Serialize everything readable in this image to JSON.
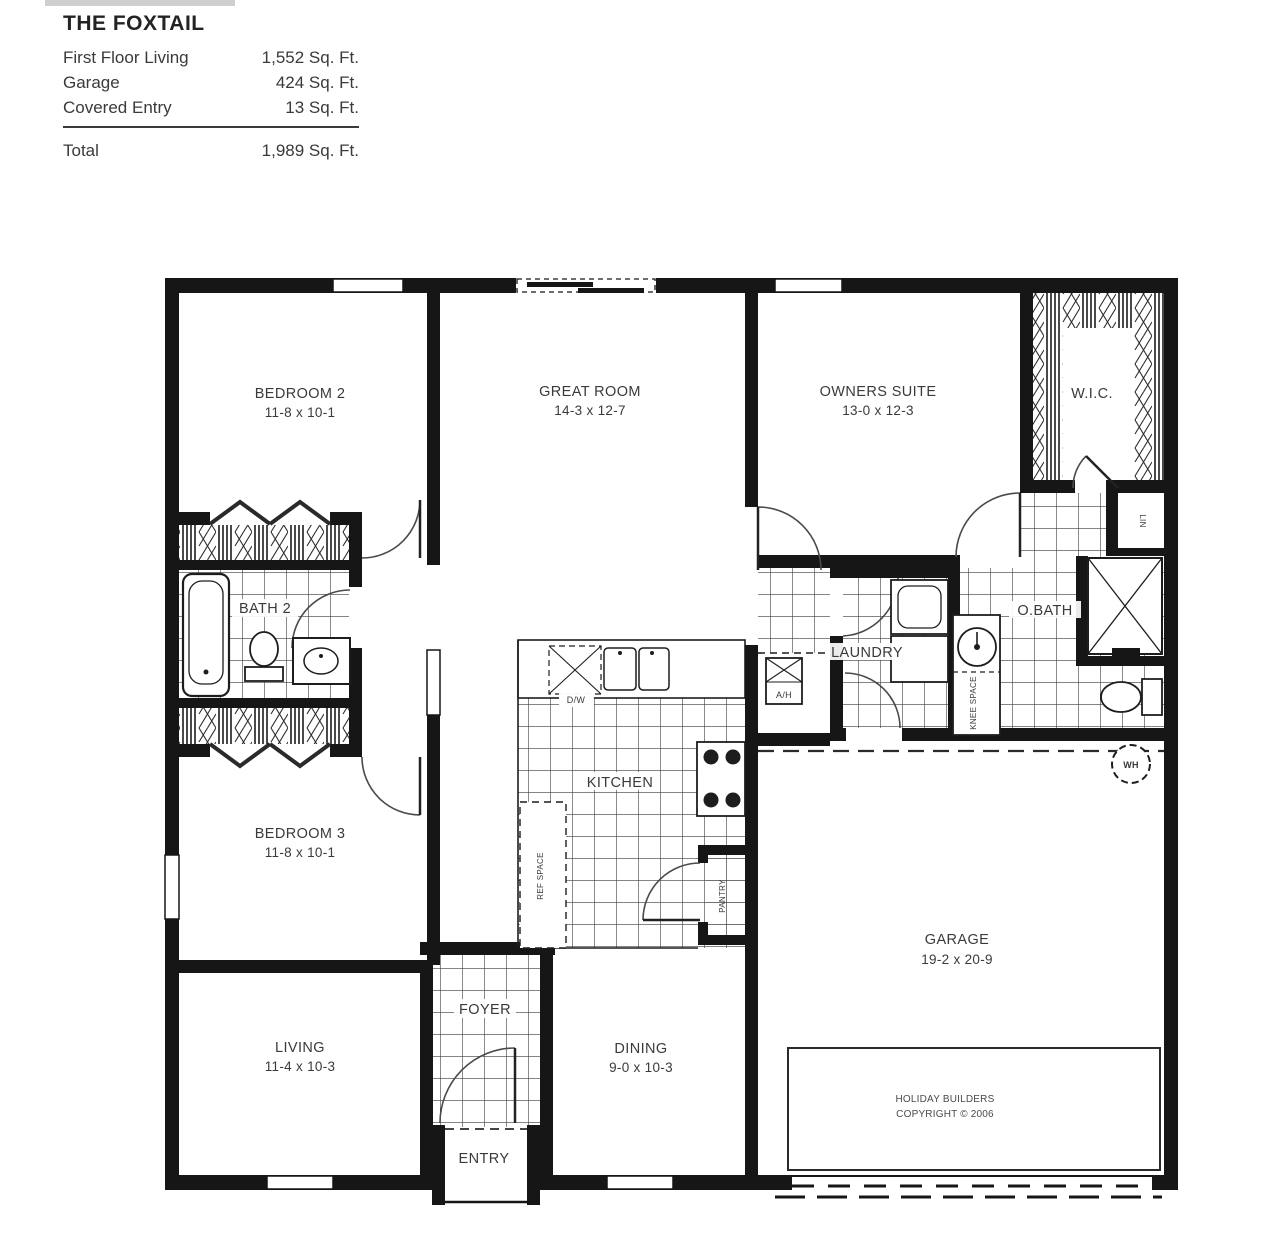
{
  "header": {
    "title": "THE FOXTAIL",
    "rows": [
      {
        "label": "First Floor Living",
        "value": "1,552 Sq. Ft."
      },
      {
        "label": "Garage",
        "value": "424 Sq. Ft."
      },
      {
        "label": "Covered Entry",
        "value": "13 Sq. Ft."
      }
    ],
    "total_label": "Total",
    "total_value": "1,989 Sq. Ft."
  },
  "rooms": {
    "bedroom2": {
      "name": "BEDROOM 2",
      "dims": "11-8 x 10-1"
    },
    "great_room": {
      "name": "GREAT ROOM",
      "dims": "14-3 x 12-7"
    },
    "owners_suite": {
      "name": "OWNERS SUITE",
      "dims": "13-0 x 12-3"
    },
    "wic": {
      "name": "W.I.C."
    },
    "bath2": {
      "name": "BATH 2"
    },
    "laundry": {
      "name": "LAUNDRY"
    },
    "obath": {
      "name": "O.BATH"
    },
    "kitchen": {
      "name": "KITCHEN"
    },
    "bedroom3": {
      "name": "BEDROOM 3",
      "dims": "11-8 x 10-1"
    },
    "living": {
      "name": "LIVING",
      "dims": "11-4 x 10-3"
    },
    "foyer": {
      "name": "FOYER"
    },
    "dining": {
      "name": "DINING",
      "dims": "9-0 x 10-3"
    },
    "garage": {
      "name": "GARAGE",
      "dims": "19-2 x 20-9"
    },
    "entry": {
      "name": "ENTRY"
    }
  },
  "fixtures": {
    "dishwasher": "D/W",
    "ref_space": "REF SPACE",
    "pantry": "PANTRY",
    "air_handler": "A/H",
    "water_heater": "WH",
    "linen": "LIN",
    "knee_space": "KNEE SPACE"
  },
  "copyright": {
    "line1": "HOLIDAY BUILDERS",
    "line2": "COPYRIGHT © 2006"
  },
  "colors": {
    "wall": "#161616",
    "text": "#3a3a3a"
  }
}
